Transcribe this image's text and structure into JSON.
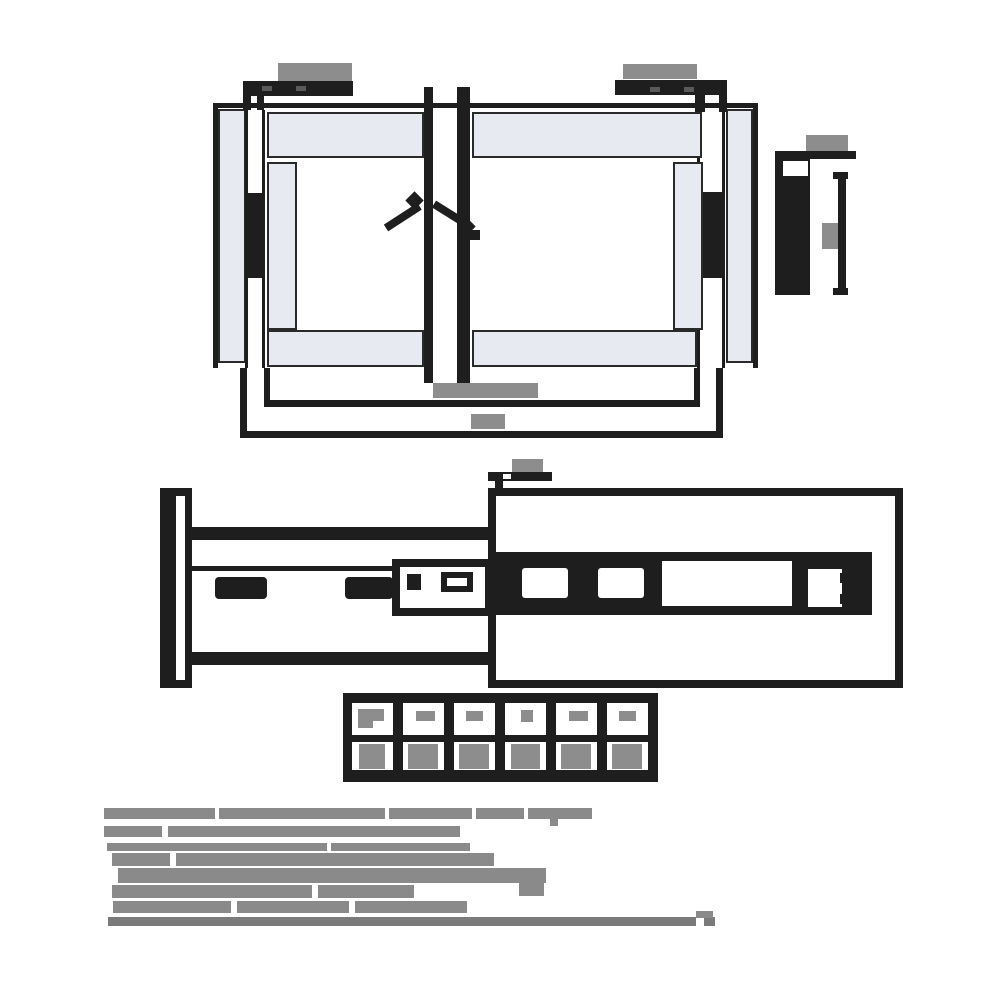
{
  "title": "drawer-slide-technical-drawing",
  "colors": {
    "ink": "#1e1e1e",
    "panel_fill": "#e7eaf1",
    "panel_outline": "#2a2a2a",
    "label_blob": "#8d8d8d",
    "note_text": "#8a8a8a",
    "note_text_dark": "#7b7b7b",
    "background": "#ffffff"
  },
  "labels": [
    {
      "name": "bracket-left-dimension-label",
      "x": 278,
      "y": 63,
      "w": 74,
      "h": 18
    },
    {
      "name": "bracket-right-dimension-label",
      "x": 623,
      "y": 64,
      "w": 74,
      "h": 15
    },
    {
      "name": "profile-top-dimension-label",
      "x": 806,
      "y": 135,
      "w": 42,
      "h": 16
    },
    {
      "name": "profile-middle-dimension-label",
      "x": 822,
      "y": 223,
      "w": 16,
      "h": 26
    },
    {
      "name": "front-inner-width-dimension-label",
      "x": 433,
      "y": 383,
      "w": 105,
      "h": 15
    },
    {
      "name": "front-outer-width-dimension-label",
      "x": 471,
      "y": 414,
      "w": 34,
      "h": 15
    },
    {
      "name": "side-view-top-dimension-label",
      "x": 512,
      "y": 459,
      "w": 31,
      "h": 13
    }
  ],
  "bracket_ticks": [
    {
      "name": "bracket-left-screw-slot-1",
      "x": 262,
      "y": 86,
      "w": 10,
      "h": 5
    },
    {
      "name": "bracket-left-screw-slot-2",
      "x": 296,
      "y": 86,
      "w": 10,
      "h": 5
    },
    {
      "name": "bracket-right-screw-slot-1",
      "x": 650,
      "y": 87,
      "w": 10,
      "h": 5
    },
    {
      "name": "bracket-right-screw-slot-2",
      "x": 684,
      "y": 87,
      "w": 10,
      "h": 5
    }
  ],
  "size_table": {
    "frame": {
      "x": 343,
      "y": 693,
      "w": 315,
      "h": 89
    },
    "header_row": {
      "y": 703,
      "h": 32
    },
    "value_row": {
      "y": 742,
      "h": 28
    },
    "cell_w": 41,
    "columns": [
      {
        "x": 352,
        "hb": [
          6,
          6,
          26,
          12
        ],
        "hb_tail": [
          6,
          17,
          15,
          8
        ],
        "vb": [
          7,
          2,
          26,
          25
        ]
      },
      {
        "x": 403,
        "hb": [
          13,
          8,
          19,
          10
        ],
        "vb": [
          5,
          2,
          30,
          25
        ]
      },
      {
        "x": 454,
        "hb": [
          12,
          8,
          17,
          10
        ],
        "vb": [
          5,
          2,
          30,
          25
        ]
      },
      {
        "x": 505,
        "hb": [
          16,
          7,
          12,
          12
        ],
        "vb": [
          6,
          2,
          29,
          25
        ]
      },
      {
        "x": 556,
        "hb": [
          13,
          8,
          19,
          10
        ],
        "vb": [
          5,
          2,
          30,
          25
        ]
      },
      {
        "x": 607,
        "hb": [
          12,
          8,
          17,
          10
        ],
        "vb": [
          5,
          2,
          30,
          25
        ]
      }
    ]
  },
  "notes": {
    "color": "#8a8a8a",
    "lines": [
      {
        "y": 808,
        "h": 11,
        "seg": [
          [
            104,
            111
          ],
          [
            219,
            166
          ],
          [
            389,
            83
          ],
          [
            476,
            48
          ],
          [
            528,
            64
          ]
        ]
      },
      {
        "y": 826,
        "h": 11,
        "seg": [
          [
            104,
            58
          ],
          [
            168,
            292
          ]
        ]
      },
      {
        "y": 843,
        "h": 8,
        "seg": [
          [
            107,
            220
          ],
          [
            331,
            139
          ]
        ]
      },
      {
        "y": 853,
        "h": 13,
        "seg": [
          [
            112,
            58
          ],
          [
            176,
            318
          ]
        ]
      },
      {
        "y": 868,
        "h": 15,
        "seg": [
          [
            118,
            428
          ]
        ]
      },
      {
        "y": 885,
        "h": 13,
        "seg": [
          [
            112,
            200
          ],
          [
            318,
            96
          ]
        ]
      },
      {
        "y": 901,
        "h": 12,
        "seg": [
          [
            113,
            118
          ],
          [
            237,
            112
          ],
          [
            355,
            112
          ]
        ]
      },
      {
        "y": 917,
        "h": 9,
        "color": "#7b7b7b",
        "seg": [
          [
            108,
            588
          ],
          [
            704,
            11
          ]
        ]
      }
    ],
    "extra": [
      {
        "name": "note-descender",
        "x": 550,
        "y": 819,
        "w": 8,
        "h": 7
      },
      {
        "name": "note-block-right",
        "x": 519,
        "y": 872,
        "w": 25,
        "h": 24
      },
      {
        "name": "note-step-right",
        "x": 696,
        "y": 911,
        "w": 17,
        "h": 7
      }
    ]
  }
}
